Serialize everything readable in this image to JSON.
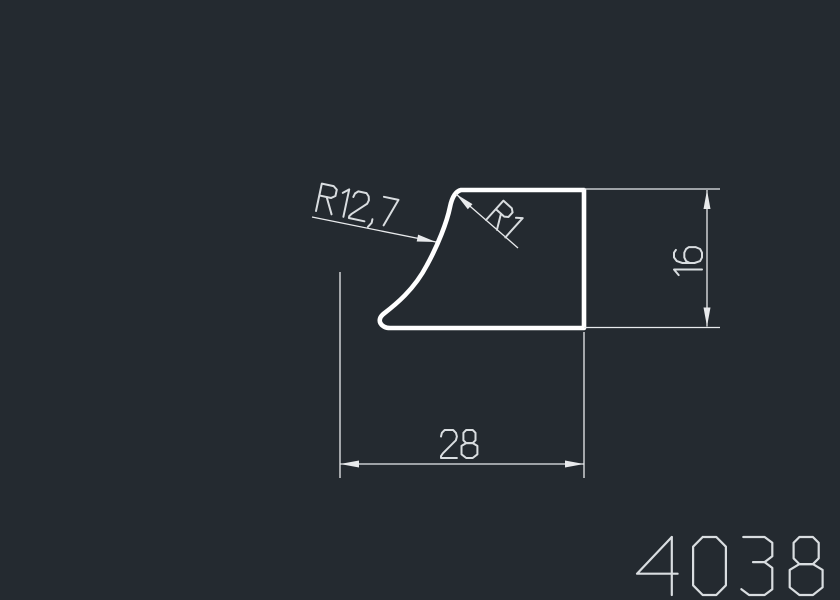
{
  "drawing": {
    "part_number": "4038",
    "labels": {
      "radius_large": "R12,7",
      "radius_small": "R1",
      "width": "28",
      "height": "16"
    },
    "colors": {
      "background": "#242a30",
      "profile_stroke": "#ffffff",
      "dimension_stroke": "#e8eaec",
      "text_stroke": "#d9dde0"
    }
  }
}
